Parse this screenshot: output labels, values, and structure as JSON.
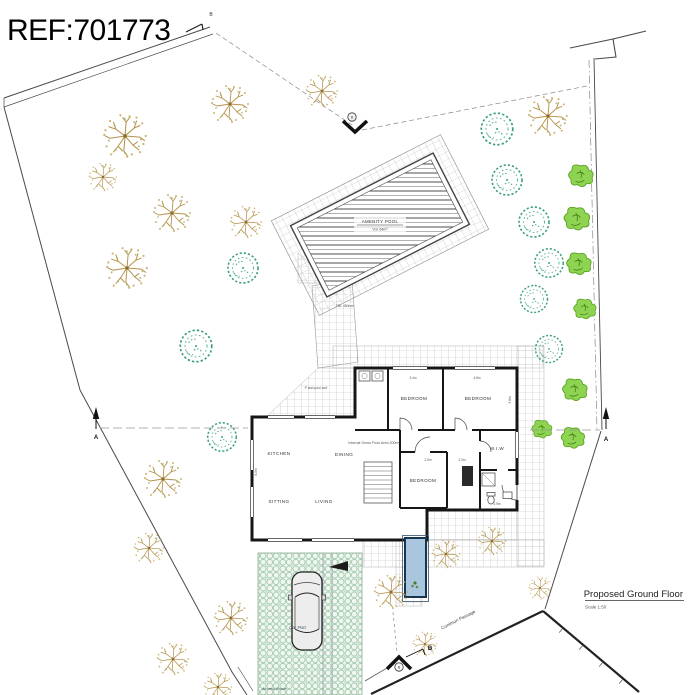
{
  "ref_label": "REF:701773",
  "title_block": {
    "title": "Proposed Ground Floor",
    "scale": "Scale 1:50"
  },
  "pool": {
    "name": "AMENITY POOL",
    "volume": "Vol: 64m³"
  },
  "annotations": {
    "common_passage": "Common Passage",
    "car_port": "Car Port",
    "access_route": "Access Route",
    "pool_surround": "P and pool surf",
    "path_level": "TBL 450mm",
    "area_note": "Internal Gross Floor Area 200m²"
  },
  "rooms": {
    "kitchen": "KITCHEN",
    "dining": "DINING",
    "sitting": "SITTING",
    "living": "LIVING",
    "bedroom1": "BEDROOM",
    "bedroom2": "BEDROOM",
    "bedroom3": "BEDROOM",
    "wiw": "W.I.W"
  },
  "dimensions": {
    "d1": "3.4m",
    "d2": "4.8m",
    "d3": "3.8m",
    "d4": "2.5m",
    "d5": "2.3m",
    "d6": "2.9m",
    "d7": "6.0m"
  },
  "markers": {
    "section_a": "A",
    "section_b": "B"
  },
  "colors": {
    "wall": "#161616",
    "tree_tan": "#b5924a",
    "shrub_teal": "#3aa178",
    "tree_green": "#7cc53e",
    "water": "#a9c6de",
    "grass_paver": "#a6cdb2",
    "paving_grid": "#b9b9b9"
  }
}
